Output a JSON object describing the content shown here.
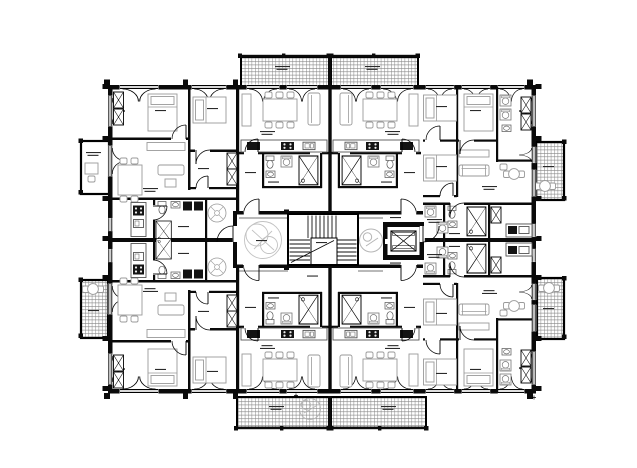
{
  "document": {
    "kind": "architectural floor plan",
    "description": "black-and-white storey plan of a multi-unit residential building, mirrored left/right and top/bottom around a central stair core",
    "legible_text": ""
  },
  "palette": {
    "background": "#ffffff",
    "walls": "#0a0a0a",
    "furniture": "#9a9a9a",
    "kitchen": "#555555",
    "appliances": "#141414",
    "balcony_hatch": "#858585",
    "label_marks": "#2a2a2a",
    "plant": "#c2c2c2",
    "wheelchair_circle": "#b5b5b5"
  },
  "inventory": {
    "apartments_visible": 8,
    "balconies_hatched": 7,
    "loggia_unhatched": 1,
    "stairwell": 1,
    "elevator": 1,
    "wheelchair_turning_circles": 2
  },
  "aria": {
    "canvas": "floor plan drawing",
    "stairwell": "central U-shaped stairwell",
    "elevator": "elevator shaft",
    "corridor": "central corridor",
    "balcony": "hatched balcony",
    "loggia": "loggia with desk",
    "unit": "apartment unit",
    "plant": "decorative plant in hallway"
  }
}
